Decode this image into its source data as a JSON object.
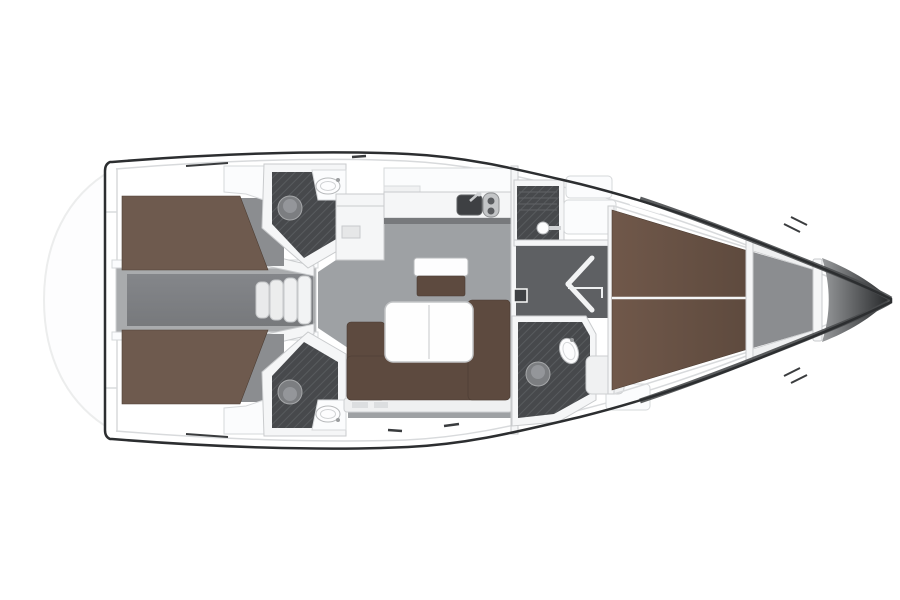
{
  "page": {
    "title": "Sailing yacht interior layout plan — top view, bow to the right",
    "background": "#ffffff"
  },
  "colors": {
    "hull_outline": "#2c2e30",
    "deck_white": "#ffffff",
    "inner_line": "#d7d9db",
    "platform_stroke": "#eceded",
    "bed_brown": "#6e5a4e",
    "vberth_light": "#70584a",
    "vberth_dark": "#5e4a3e",
    "sofa_brown": "#5d4a3f",
    "salon_floor": "#9ea1a4",
    "corridor_frame": "#a9abad",
    "corridor_floor": "#77797c",
    "passage_floor": "#5e6063",
    "cabin_floor": "#8b8d90",
    "wet_floor": "#47494c",
    "wet_floor_hatch": "#585b5e",
    "fixture_gray": "#7c7e81",
    "appliance_dark": "#3e4043",
    "bow_light": "#9b9d9f",
    "bow_dark": "#232527"
  },
  "plan": {
    "type": "yacht-floor-plan",
    "orientation": "bow-right",
    "regions": [
      {
        "id": "swim-platform",
        "label": "swim platform"
      },
      {
        "id": "aft-cabin-port",
        "label": "aft double cabin port"
      },
      {
        "id": "aft-cabin-starboard",
        "label": "aft double cabin starboard"
      },
      {
        "id": "engine-corridor",
        "label": "engine compartment corridor"
      },
      {
        "id": "head-aft-port",
        "label": "aft head WC and basin port"
      },
      {
        "id": "head-aft-starboard",
        "label": "aft head WC and basin starboard"
      },
      {
        "id": "companionway",
        "label": "companionway steps"
      },
      {
        "id": "galley",
        "label": "galley with sink and two-burner stove"
      },
      {
        "id": "salon",
        "label": "salon with L-sofa and folding table"
      },
      {
        "id": "shower-forward",
        "label": "forward shower compartment"
      },
      {
        "id": "head-forward",
        "label": "forward head WC and basin"
      },
      {
        "id": "forward-cabin",
        "label": "forward V-berth cabin"
      },
      {
        "id": "anchor-locker",
        "label": "anchor locker and bow"
      }
    ]
  }
}
